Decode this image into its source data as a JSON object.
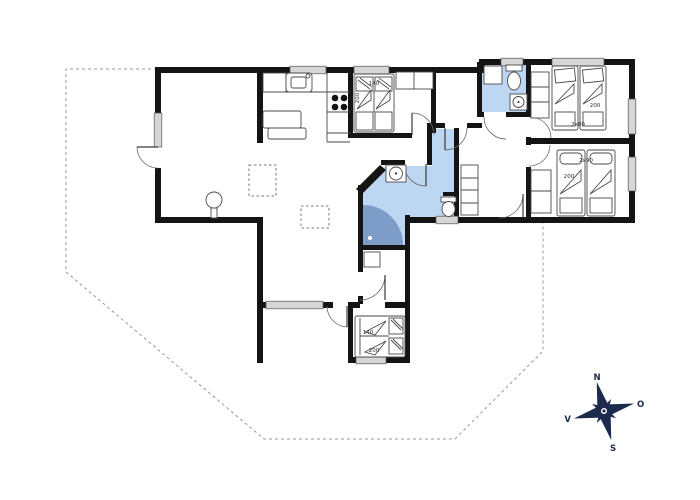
{
  "labels": {
    "bedroom_top": {
      "width": "140",
      "length": "200"
    },
    "bedroom_right_top": {
      "beds": "2x80",
      "length": "200"
    },
    "bedroom_right_mid": {
      "beds": "2x90",
      "length": "200"
    },
    "bedroom_bottom": {
      "width": "140",
      "length": "200"
    },
    "compass": {
      "north": "N",
      "east": "O",
      "south": "S",
      "west": "V"
    }
  },
  "colors": {
    "wall": "#141414",
    "bathroom_fill": "#bdd7f2",
    "shower_fill": "#7e9cc8",
    "window_fill": "#d6d6d6",
    "compass": "#1c2b4d",
    "dash": "#999999",
    "skylight_dash": "#777777"
  }
}
